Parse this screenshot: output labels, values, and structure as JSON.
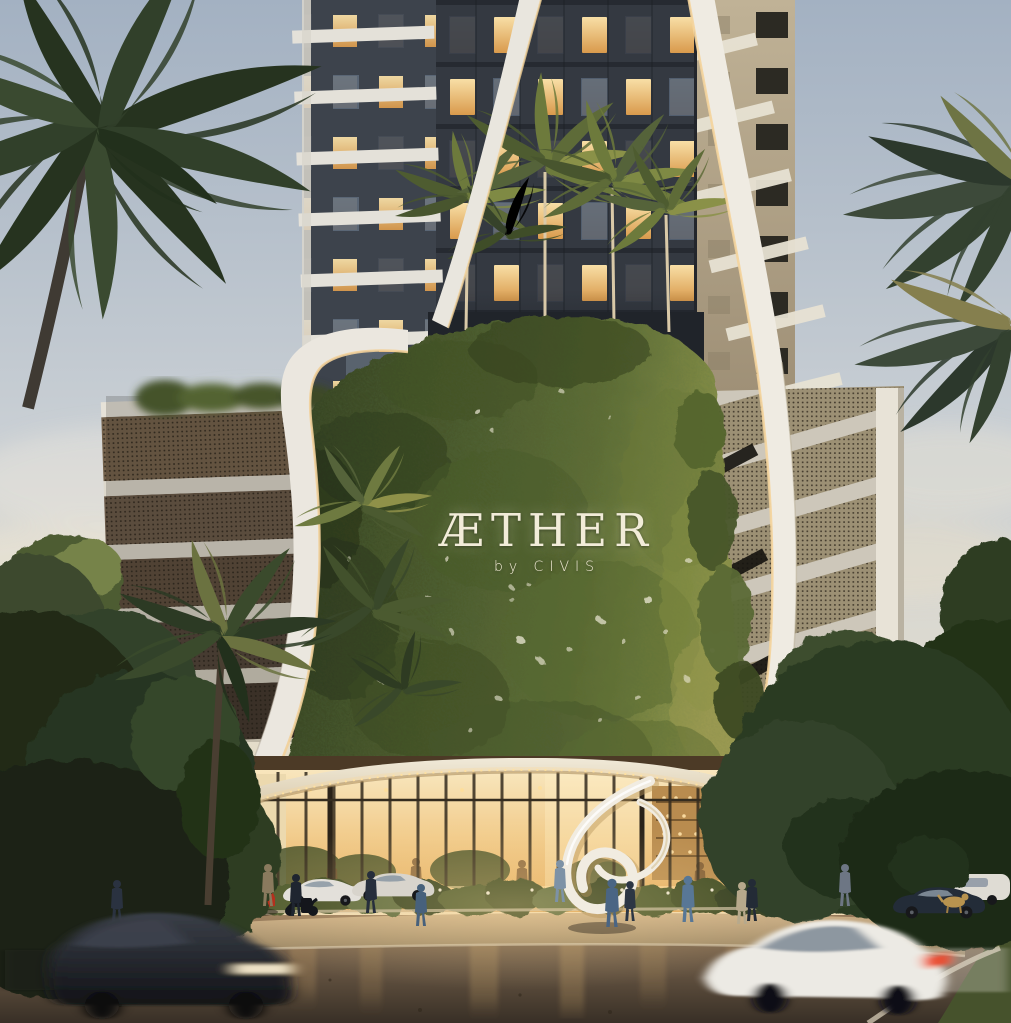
{
  "branding": {
    "title": "ÆTHER",
    "subtitle": "by CIVIS",
    "text_color": "#f2ecd9"
  },
  "palette": {
    "sky_top": "#a3b1c2",
    "sky_warm_horizon": "#f0dcb4",
    "tower_facade_dark": "#343941",
    "window_glow": "#f3cd84",
    "ribbon_white": "#ece8df",
    "beige_wing": "#b4a68c",
    "green_wall": "#4e5e31",
    "foliage_dark": "#26331d",
    "podium_mesh_bronze": "#6a5948",
    "canopy_cream": "#f0e9d8",
    "storefront_glow": "#f2cd8e",
    "street_asphalt_warm": "#6a5845",
    "red_sports_car": "#b5301d",
    "white_car": "#e8e6e0",
    "black_suv": "#1c1f24"
  },
  "scene": {
    "setting": "dusk",
    "objects": [
      "residential tower",
      "living green wall with logo sign",
      "curved white ribbon facade",
      "podium parking screen",
      "glowing retail storefront",
      "entry canopy with string lights",
      "white ribbon sculpture",
      "palm trees",
      "street with moving and parked cars",
      "pedestrians walking",
      "dog"
    ]
  }
}
